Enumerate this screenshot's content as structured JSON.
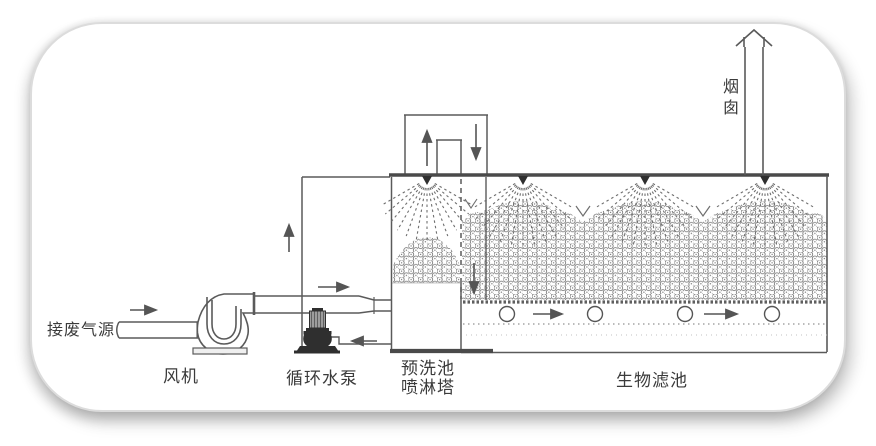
{
  "diagram": {
    "type": "process-flow-diagram",
    "subject": "waste-gas biofiltration system",
    "components": [
      {
        "id": "inlet",
        "label": "接废气源",
        "type": "gas-inlet-pipe"
      },
      {
        "id": "fan",
        "label": "风机",
        "type": "blower"
      },
      {
        "id": "pump",
        "label": "循环水泵",
        "type": "circulation-pump"
      },
      {
        "id": "prewash",
        "label": "预洗池\n喷淋塔",
        "type": "prewash-spray-tower"
      },
      {
        "id": "biofilter",
        "label": "生物滤池",
        "type": "biofilter-bed"
      },
      {
        "id": "chimney",
        "label": "烟囱",
        "type": "exhaust-stack"
      }
    ],
    "flow_arrows": [
      {
        "name": "inlet-flow",
        "direction": "right"
      },
      {
        "name": "duct-flow",
        "direction": "right"
      },
      {
        "name": "tower-riser-flow",
        "direction": "up"
      },
      {
        "name": "gooseneck-up-flow",
        "direction": "up"
      },
      {
        "name": "gooseneck-down-flow",
        "direction": "down"
      },
      {
        "name": "downcomer-flow",
        "direction": "down"
      },
      {
        "name": "return-pipe-flow",
        "direction": "left"
      },
      {
        "name": "plenum-flow-1",
        "direction": "right"
      },
      {
        "name": "plenum-flow-2",
        "direction": "right"
      }
    ],
    "spray_nozzle_count": 4,
    "colors": {
      "line": "#5a5a5a",
      "thick_line": "#4a4a4a",
      "equipment_fill": "#2e2e2e",
      "media_pattern": "#7d7d7d",
      "text": "#3b3b3b",
      "card_border": "#dcdcdc"
    }
  }
}
